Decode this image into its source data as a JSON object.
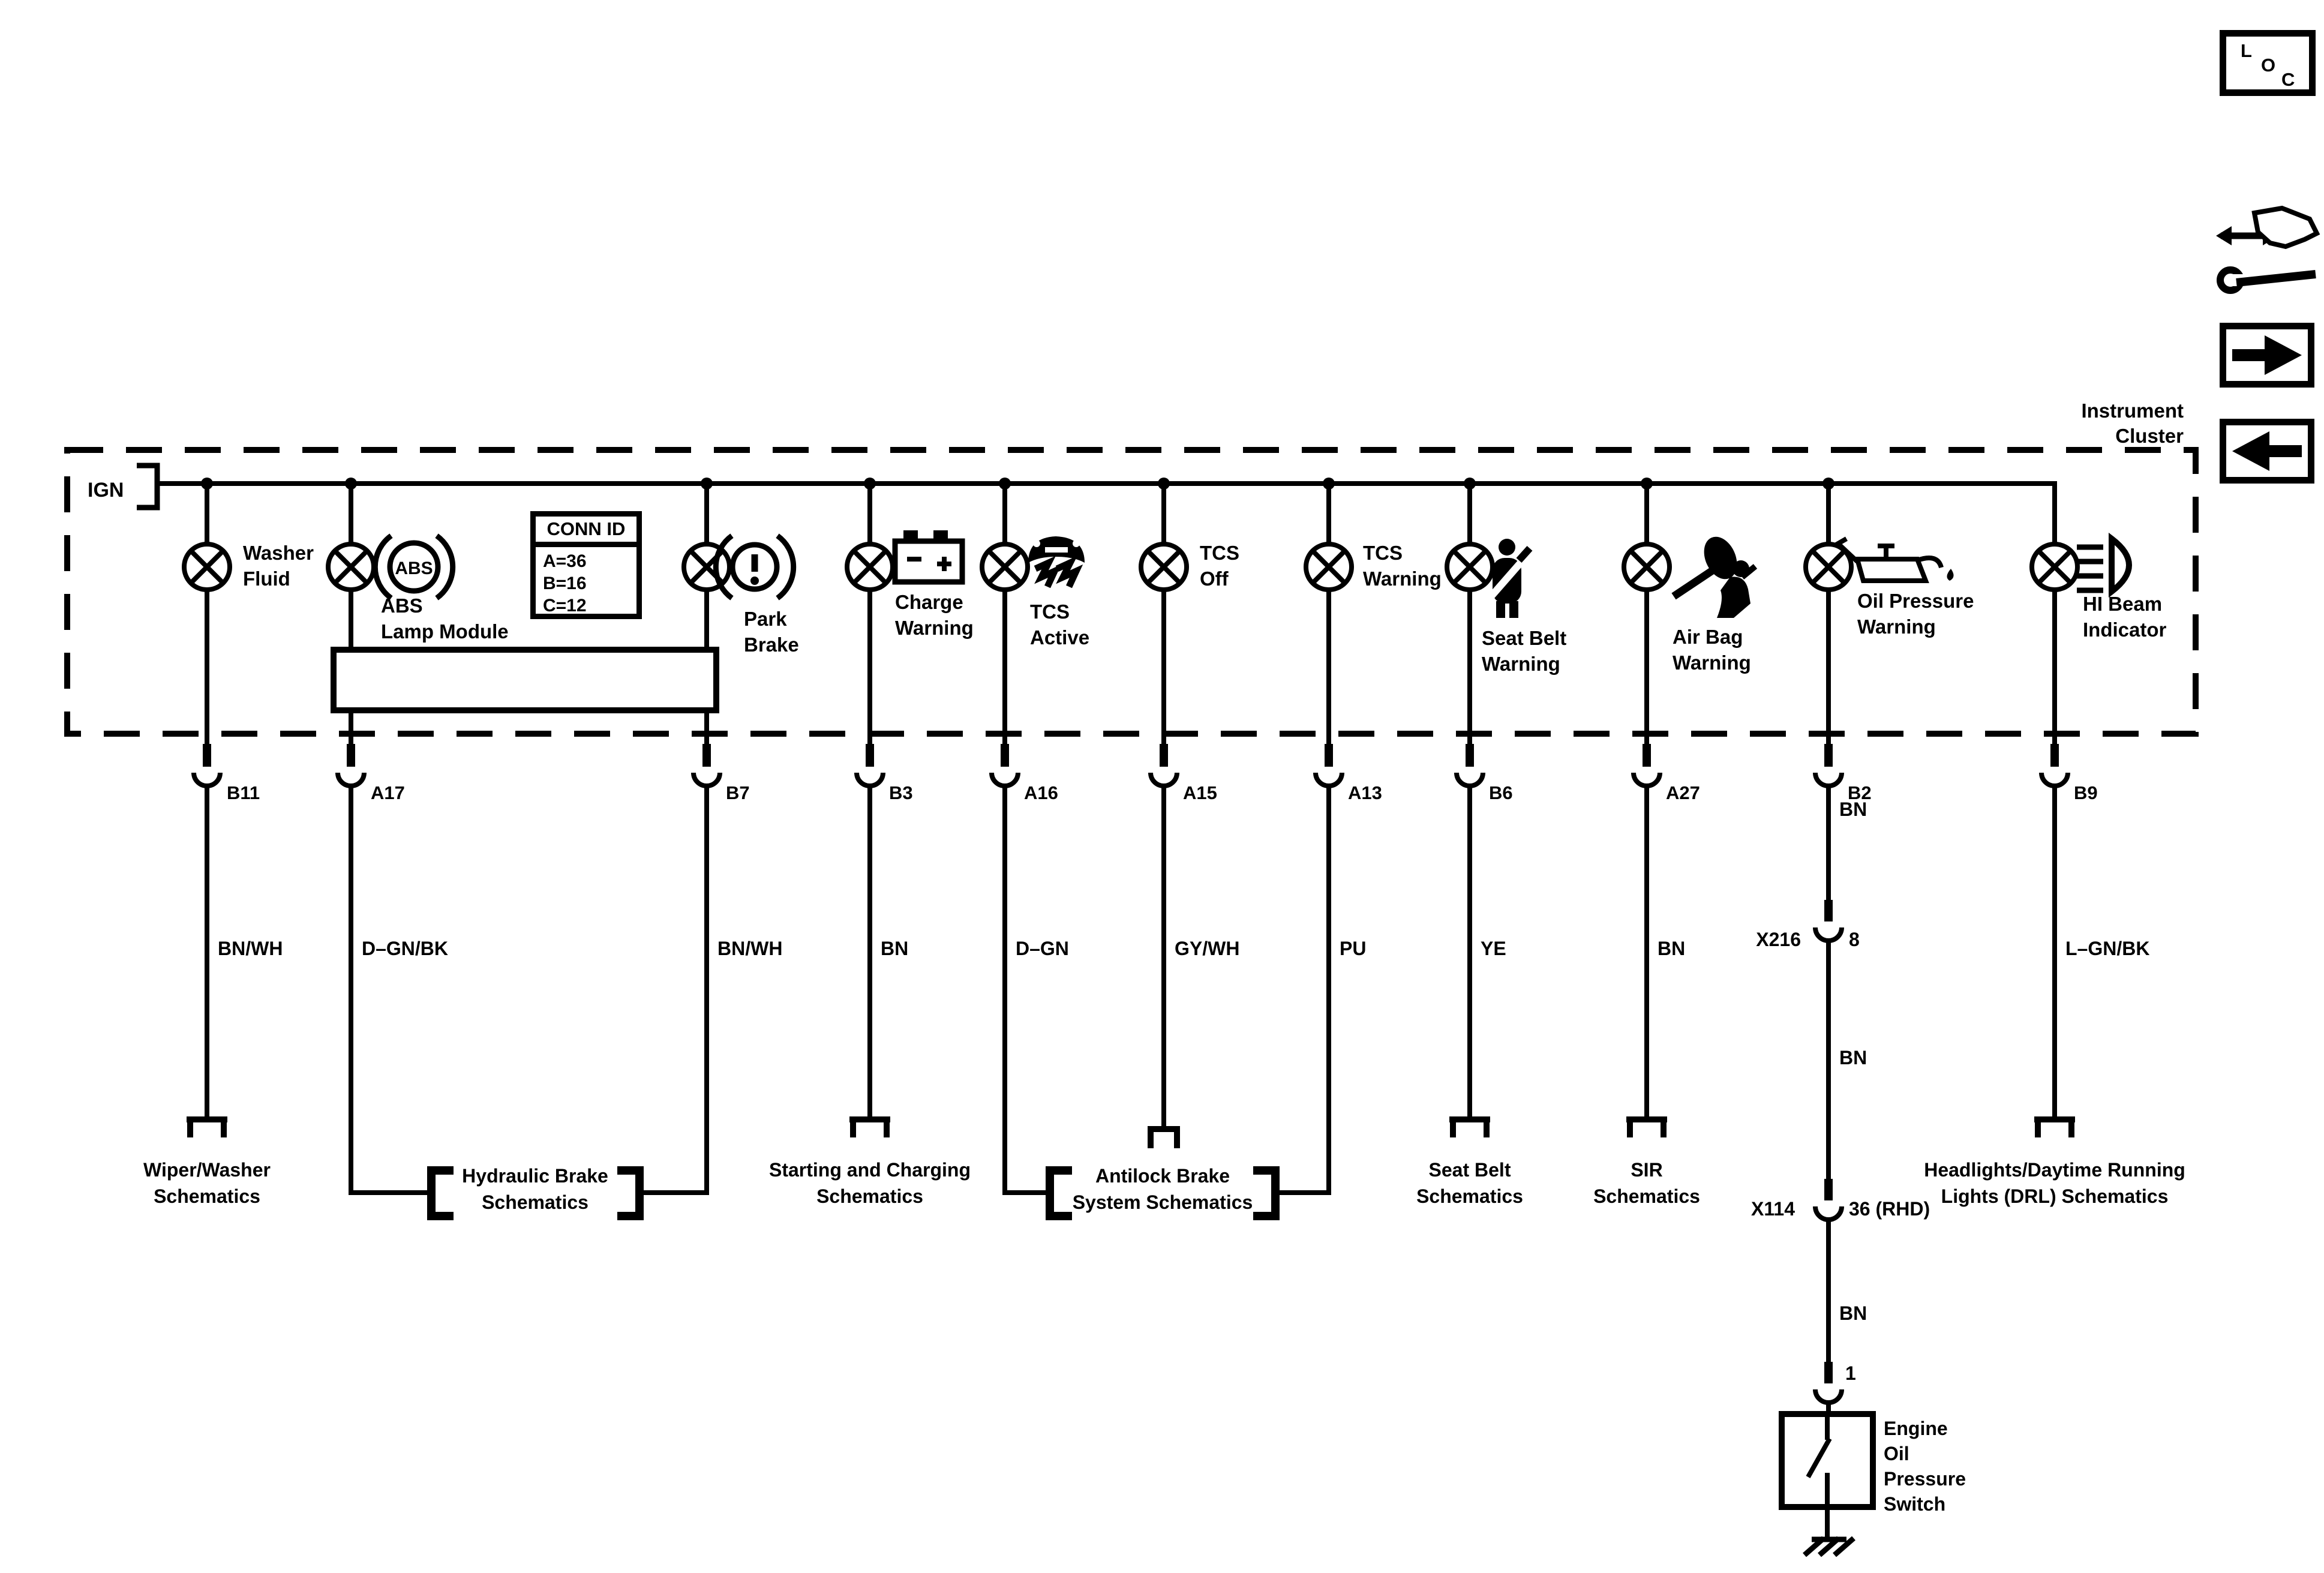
{
  "cluster": {
    "title_lines": [
      "Instrument",
      "Cluster"
    ],
    "ign_label": "IGN"
  },
  "conn_id": {
    "title": "CONN ID",
    "rows": [
      "A=36",
      "B=16",
      "C=12"
    ]
  },
  "nav": {
    "loc_letters": [
      "L",
      "O",
      "C"
    ]
  },
  "icons": {
    "abs_text": "ABS",
    "park_text": "!"
  },
  "branches": [
    {
      "label_lines": [
        "Washer",
        "Fluid"
      ],
      "pin": "B11",
      "wire_color": "BN/WH"
    },
    {
      "label_lines": [
        "ABS",
        "Lamp Module"
      ],
      "pin": "A17",
      "wire_color": "D–GN/BK"
    },
    {
      "label_lines": [
        "Park",
        "Brake"
      ],
      "pin": "B7",
      "wire_color": "BN/WH"
    },
    {
      "label_lines": [
        "Charge",
        "Warning"
      ],
      "pin": "B3",
      "wire_color": "BN"
    },
    {
      "label_lines": [
        "TCS",
        "Active"
      ],
      "pin": "A16",
      "wire_color": "D–GN"
    },
    {
      "label_lines": [
        "TCS",
        "Off"
      ],
      "pin": "A15",
      "wire_color": "GY/WH"
    },
    {
      "label_lines": [
        "TCS",
        "Warning"
      ],
      "pin": "A13",
      "wire_color": "PU"
    },
    {
      "label_lines": [
        "Seat Belt",
        "Warning"
      ],
      "pin": "B6",
      "wire_color": "YE"
    },
    {
      "label_lines": [
        "Air Bag",
        "Warning"
      ],
      "pin": "A27",
      "wire_color": "BN"
    },
    {
      "label_lines": [
        "Oil Pressure",
        "Warning"
      ],
      "pin": "B2"
    },
    {
      "label_lines": [
        "HI Beam",
        "Indicator"
      ],
      "pin": "B9",
      "wire_color": "L–GN/BK"
    }
  ],
  "destinations": {
    "wiper": [
      "Wiper/Washer",
      "Schematics"
    ],
    "hydraulic": [
      "Hydraulic Brake",
      "Schematics"
    ],
    "starting": [
      "Starting and Charging",
      "Schematics"
    ],
    "antilock": [
      "Antilock Brake",
      "System Schematics"
    ],
    "seat_belt": [
      "Seat Belt",
      "Schematics"
    ],
    "sir": [
      "SIR",
      "Schematics"
    ],
    "headlights": [
      "Headlights/Daytime Running",
      "Lights (DRL) Schematics"
    ]
  },
  "b2_chain": {
    "wire1": "BN",
    "conn1_name": "X216",
    "conn1_pin": "8",
    "wire2": "BN",
    "conn2_name": "X114",
    "conn2_pin": "36 (RHD)",
    "wire3": "BN",
    "pin_in": "1",
    "component_lines": [
      "Engine",
      "Oil",
      "Pressure",
      "Switch"
    ]
  }
}
